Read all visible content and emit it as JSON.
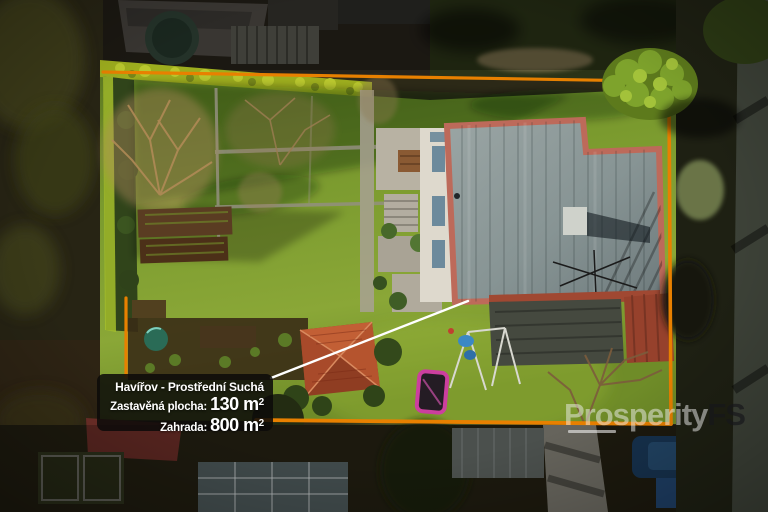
{
  "label": {
    "title": "Havířov - Prostřední Suchá",
    "built_area_label": "Zastavěná plocha:",
    "built_area_value": "130 m",
    "built_area_exponent": "2",
    "garden_label": "Zahrada:",
    "garden_value": "800 m",
    "garden_exponent": "2"
  },
  "watermark": {
    "brand_primary": "Prosperity",
    "brand_suffix": "FS"
  },
  "colors": {
    "boundary_line": "#E88000",
    "pointer_line": "#FFFFFF",
    "card_background": "rgba(12,11,9,0.86)",
    "card_text": "#FFFFFF",
    "trampoline_pink": "#CC3F9E"
  }
}
